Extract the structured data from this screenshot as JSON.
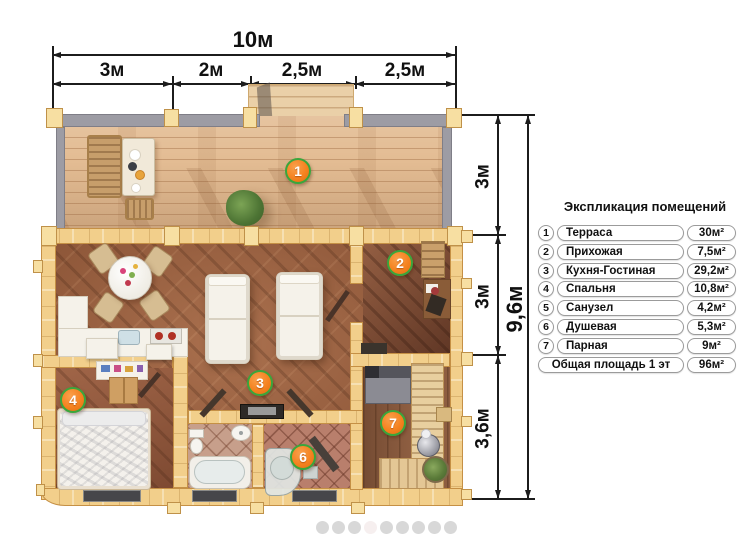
{
  "dimensions": {
    "top": {
      "total": "10м",
      "segments": [
        "3м",
        "2м",
        "2,5м",
        "2,5м"
      ]
    },
    "right": {
      "total": "9,6м",
      "segments": [
        "3м",
        "3м",
        "3,6м"
      ]
    }
  },
  "legend": {
    "title": "Экспликация помещений",
    "rows": [
      {
        "num": "1",
        "name": "Терраса",
        "area": "30м²"
      },
      {
        "num": "2",
        "name": "Прихожая",
        "area": "7,5м²"
      },
      {
        "num": "3",
        "name": "Кухня-Гостиная",
        "area": "29,2м²"
      },
      {
        "num": "4",
        "name": "Спальня",
        "area": "10,8м²"
      },
      {
        "num": "5",
        "name": "Санузел",
        "area": "4,2м²"
      },
      {
        "num": "6",
        "name": "Душевая",
        "area": "5,3м²"
      },
      {
        "num": "7",
        "name": "Парная",
        "area": "9м²"
      }
    ],
    "total_row": {
      "name": "Общая площадь 1 эт",
      "area": "96м²"
    }
  },
  "plan": {
    "markers": [
      {
        "number": "1"
      },
      {
        "number": "2"
      },
      {
        "number": "3"
      },
      {
        "number": "4"
      },
      {
        "number": "6"
      },
      {
        "number": "7"
      }
    ],
    "colors": {
      "marker_fill": "#f5821f",
      "marker_border": "#3aa63c",
      "wall_wood": "#f2cf8b",
      "terrace_floor": "#e3bc93",
      "interior_floor": "#9a5c3b"
    }
  },
  "carousel": {
    "count": 9,
    "active_index": 3
  }
}
